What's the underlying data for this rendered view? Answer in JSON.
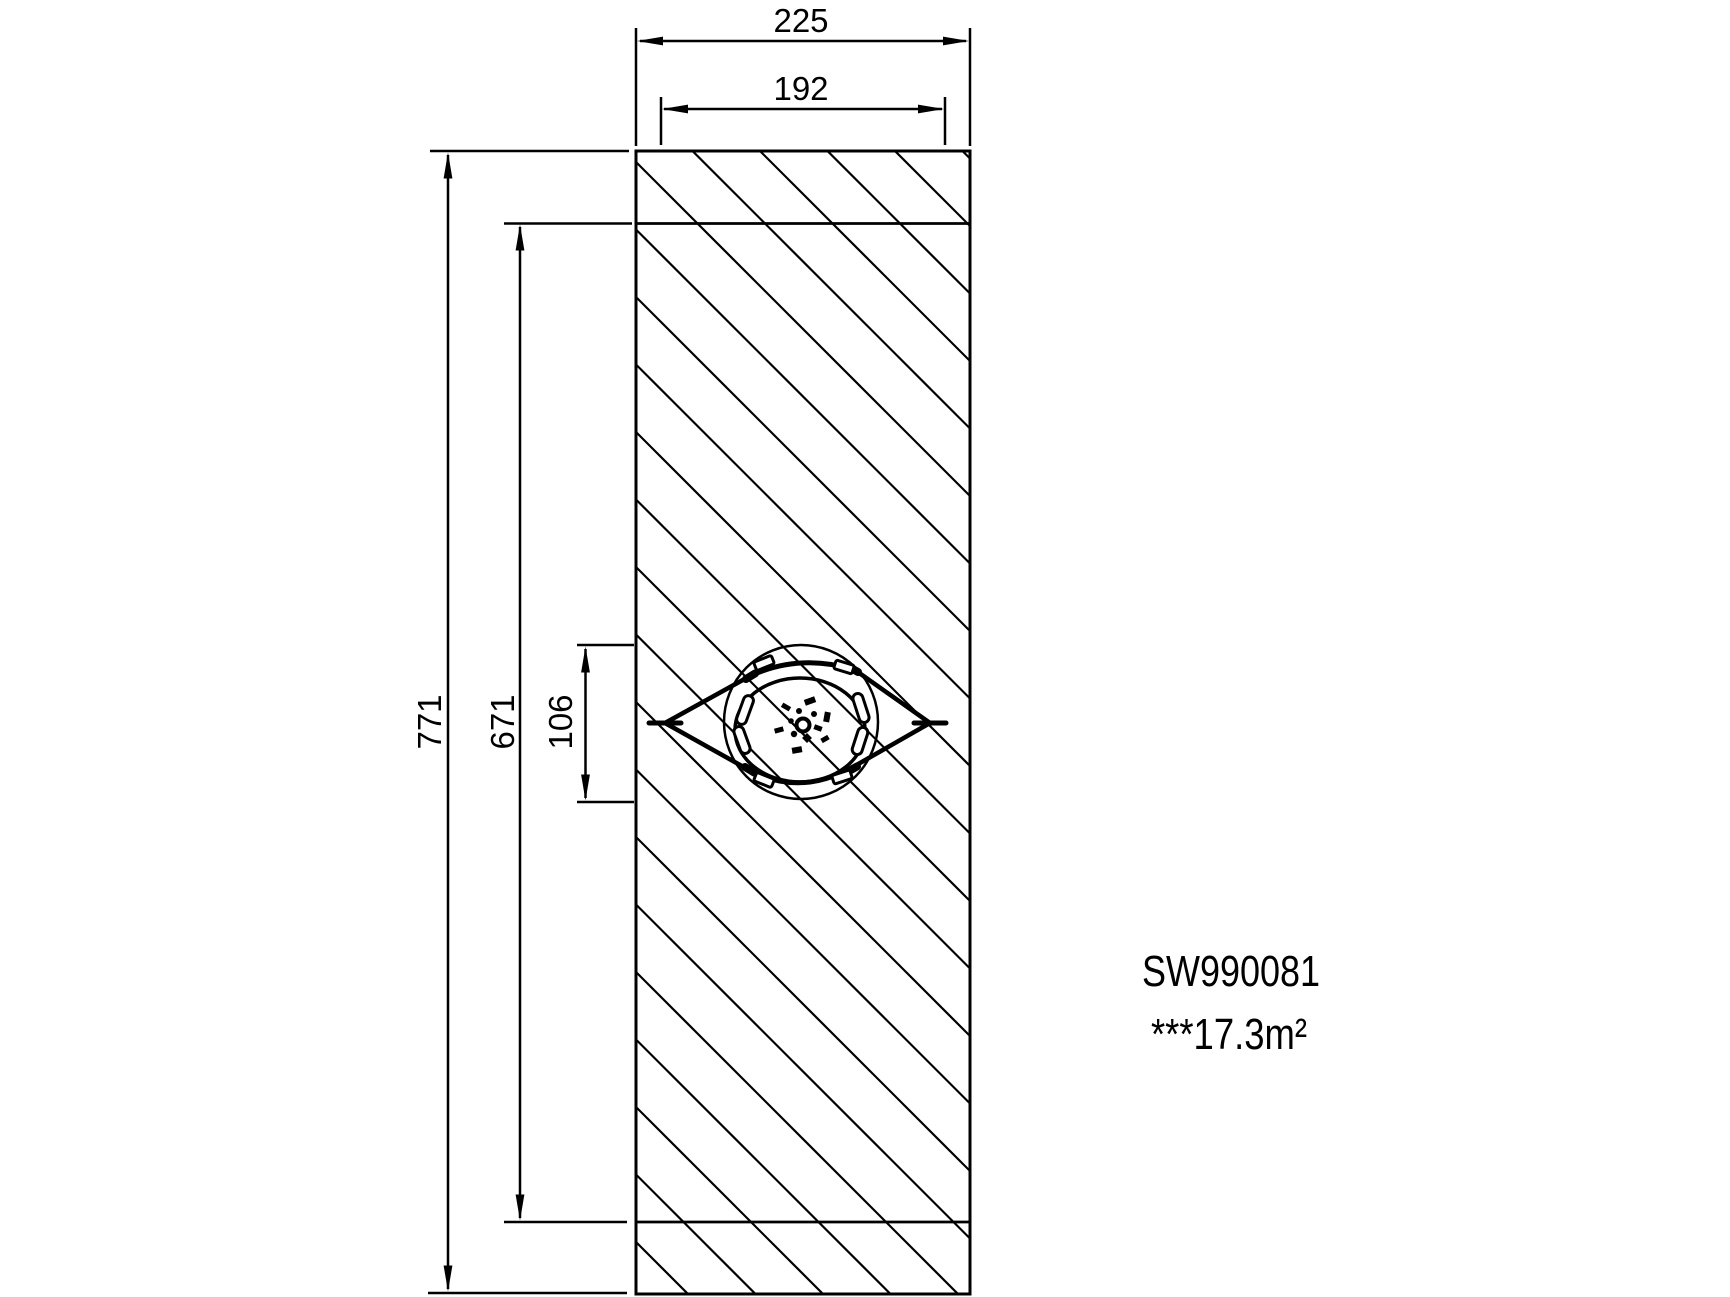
{
  "drawing": {
    "type": "technical-plan-view",
    "product_code": "SW990081",
    "safety_area_label": "***17.3m²",
    "dimensions": {
      "outer_width": "225",
      "inner_width": "192",
      "outer_height": "771",
      "inner_height": "671",
      "equipment_size": "106"
    },
    "colors": {
      "line": "#000000",
      "background": "#ffffff"
    }
  }
}
